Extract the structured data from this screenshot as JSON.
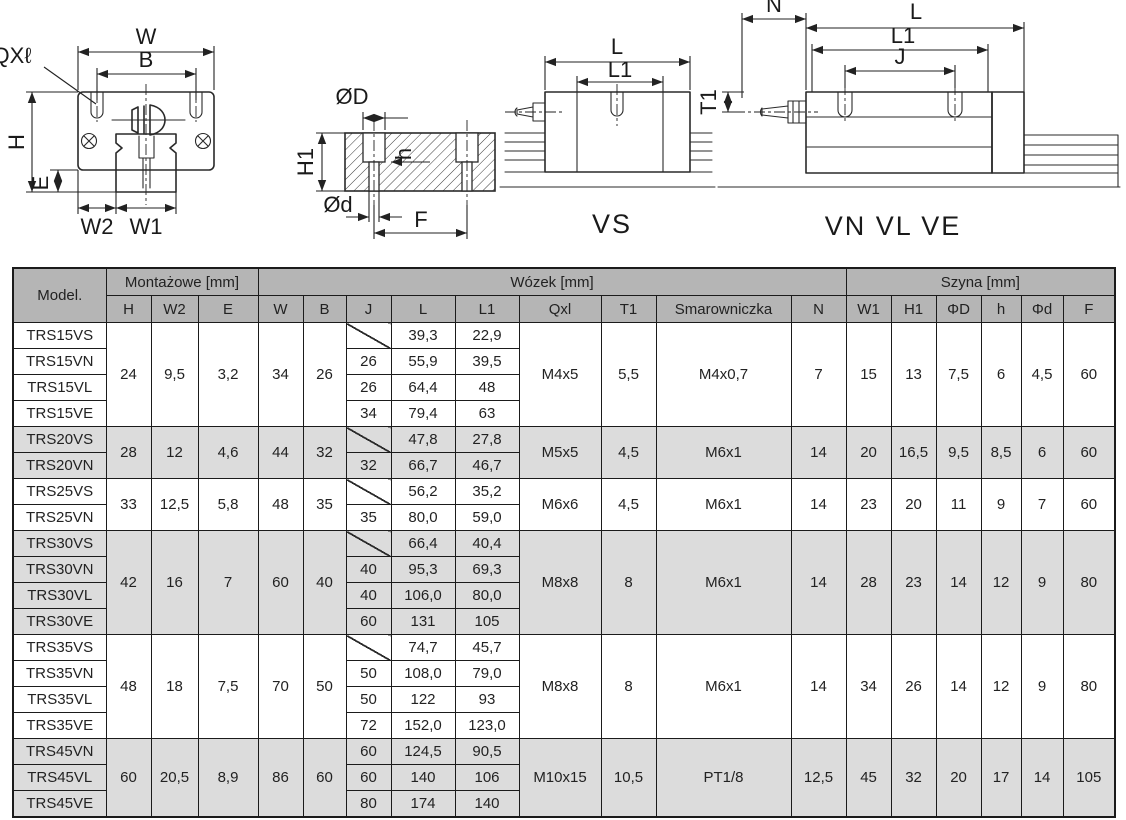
{
  "drawing": {
    "front_view": {
      "qxl": "QXℓ",
      "W": "W",
      "B": "B",
      "H": "H",
      "E": "E",
      "W2": "W2",
      "W1": "W1"
    },
    "rail_section": {
      "OD": "ØD",
      "H1": "H1",
      "h": "h",
      "Od": "Ød",
      "F": "F"
    },
    "vs_view": {
      "L": "L",
      "L1": "L1",
      "caption": "VS"
    },
    "vn_view": {
      "N": "N",
      "L": "L",
      "L1": "L1",
      "J": "J",
      "T1": "T1",
      "caption": "VN VL VE"
    }
  },
  "table": {
    "header": {
      "model": "Model.",
      "groups": [
        {
          "label": "Montażowe [mm]",
          "span": 3
        },
        {
          "label": "Wózek [mm]",
          "span": 9
        },
        {
          "label": "Szyna [mm]",
          "span": 6
        }
      ],
      "columns": [
        "H",
        "W2",
        "E",
        "W",
        "B",
        "J",
        "L",
        "L1",
        "Qxl",
        "T1",
        "Smarowniczka",
        "N",
        "W1",
        "H1",
        "ΦD",
        "h",
        "Φd",
        "F"
      ]
    },
    "groups": [
      {
        "shaded": false,
        "shared": {
          "H": "24",
          "W2": "9,5",
          "E": "3,2",
          "W": "34",
          "B": "26",
          "Qxl": "M4x5",
          "T1": "5,5",
          "Smarowniczka": "M4x0,7",
          "N": "7",
          "W1": "15",
          "H1": "13",
          "PhiD": "7,5",
          "h": "6",
          "Phid": "4,5",
          "F": "60"
        },
        "rows": [
          {
            "model": "TRS15VS",
            "J": "",
            "slash": true,
            "L": "39,3",
            "L1": "22,9"
          },
          {
            "model": "TRS15VN",
            "J": "26",
            "L": "55,9",
            "L1": "39,5"
          },
          {
            "model": "TRS15VL",
            "J": "26",
            "L": "64,4",
            "L1": "48"
          },
          {
            "model": "TRS15VE",
            "J": "34",
            "L": "79,4",
            "L1": "63"
          }
        ]
      },
      {
        "shaded": true,
        "shared": {
          "H": "28",
          "W2": "12",
          "E": "4,6",
          "W": "44",
          "B": "32",
          "Qxl": "M5x5",
          "T1": "4,5",
          "Smarowniczka": "M6x1",
          "N": "14",
          "W1": "20",
          "H1": "16,5",
          "PhiD": "9,5",
          "h": "8,5",
          "Phid": "6",
          "F": "60"
        },
        "rows": [
          {
            "model": "TRS20VS",
            "J": "",
            "slash": true,
            "L": "47,8",
            "L1": "27,8"
          },
          {
            "model": "TRS20VN",
            "J": "32",
            "L": "66,7",
            "L1": "46,7"
          }
        ]
      },
      {
        "shaded": false,
        "shared": {
          "H": "33",
          "W2": "12,5",
          "E": "5,8",
          "W": "48",
          "B": "35",
          "Qxl": "M6x6",
          "T1": "4,5",
          "Smarowniczka": "M6x1",
          "N": "14",
          "W1": "23",
          "H1": "20",
          "PhiD": "11",
          "h": "9",
          "Phid": "7",
          "F": "60"
        },
        "rows": [
          {
            "model": "TRS25VS",
            "J": "",
            "slash": true,
            "L": "56,2",
            "L1": "35,2"
          },
          {
            "model": "TRS25VN",
            "J": "35",
            "L": "80,0",
            "L1": "59,0"
          }
        ]
      },
      {
        "shaded": true,
        "shared": {
          "H": "42",
          "W2": "16",
          "E": "7",
          "W": "60",
          "B": "40",
          "Qxl": "M8x8",
          "T1": "8",
          "Smarowniczka": "M6x1",
          "N": "14",
          "W1": "28",
          "H1": "23",
          "PhiD": "14",
          "h": "12",
          "Phid": "9",
          "F": "80"
        },
        "rows": [
          {
            "model": "TRS30VS",
            "J": "",
            "slash": true,
            "L": "66,4",
            "L1": "40,4"
          },
          {
            "model": "TRS30VN",
            "J": "40",
            "L": "95,3",
            "L1": "69,3"
          },
          {
            "model": "TRS30VL",
            "J": "40",
            "L": "106,0",
            "L1": "80,0"
          },
          {
            "model": "TRS30VE",
            "J": "60",
            "L": "131",
            "L1": "105"
          }
        ]
      },
      {
        "shaded": false,
        "shared": {
          "H": "48",
          "W2": "18",
          "E": "7,5",
          "W": "70",
          "B": "50",
          "Qxl": "M8x8",
          "T1": "8",
          "Smarowniczka": "M6x1",
          "N": "14",
          "W1": "34",
          "H1": "26",
          "PhiD": "14",
          "h": "12",
          "Phid": "9",
          "F": "80"
        },
        "rows": [
          {
            "model": "TRS35VS",
            "J": "",
            "slash": true,
            "L": "74,7",
            "L1": "45,7"
          },
          {
            "model": "TRS35VN",
            "J": "50",
            "L": "108,0",
            "L1": "79,0"
          },
          {
            "model": "TRS35VL",
            "J": "50",
            "L": "122",
            "L1": "93"
          },
          {
            "model": "TRS35VE",
            "J": "72",
            "L": "152,0",
            "L1": "123,0"
          }
        ]
      },
      {
        "shaded": true,
        "shared": {
          "H": "60",
          "W2": "20,5",
          "E": "8,9",
          "W": "86",
          "B": "60",
          "Qxl": "M10x15",
          "T1": "10,5",
          "Smarowniczka": "PT1/8",
          "N": "12,5",
          "W1": "45",
          "H1": "32",
          "PhiD": "20",
          "h": "17",
          "Phid": "14",
          "F": "105"
        },
        "rows": [
          {
            "model": "TRS45VN",
            "J": "60",
            "L": "124,5",
            "L1": "90,5"
          },
          {
            "model": "TRS45VL",
            "J": "60",
            "L": "140",
            "L1": "106"
          },
          {
            "model": "TRS45VE",
            "J": "80",
            "L": "174",
            "L1": "140"
          }
        ]
      }
    ]
  }
}
